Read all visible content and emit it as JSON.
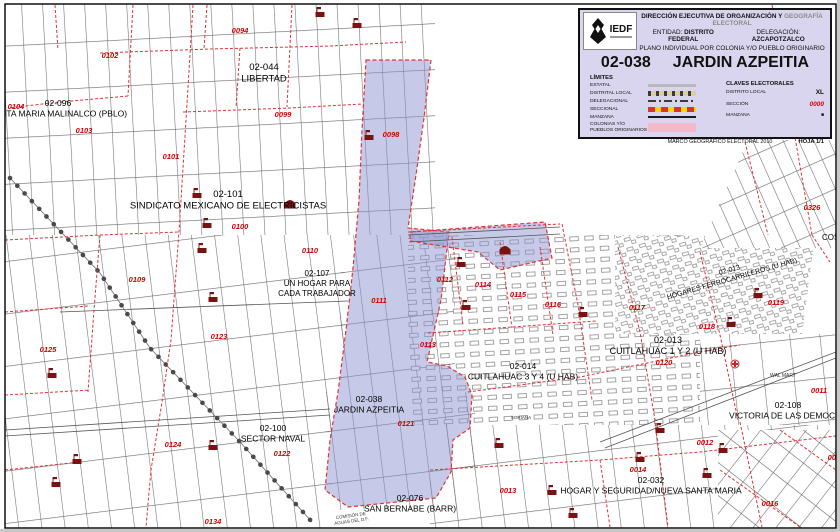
{
  "legend": {
    "logo_text": "IEDF",
    "header": {
      "line1_black": "DIRECCIÓN EJECUTIVA DE ORGANIZACIÓN Y",
      "line1_gray": "GEOGRAFÍA ELECTORAL",
      "entity_label": "ENTIDAD:",
      "entity_value": "DISTRITO FEDERAL",
      "delegation_label": "DELEGACIÓN:",
      "delegation_value": "AZCAPOTZALCO",
      "line3": "PLANO INDIVIDUAL POR COLONIA Y/O PUEBLO ORIGINARIO"
    },
    "title": {
      "code": "02-038",
      "name": "JARDIN AZPEITIA"
    },
    "limits": {
      "heading": "LÍMITES",
      "rows": [
        {
          "label": "ESTATAL",
          "symbol": "estatal-line"
        },
        {
          "label": "DISTRITAL LOCAL",
          "symbol": "dotted-line"
        },
        {
          "label": "DELEGACIONAL",
          "symbol": "dash-dot-line"
        },
        {
          "label": "SECCIONAL",
          "symbol": "yellow-red-dashed-band"
        },
        {
          "label": "MANZANA",
          "symbol": "solid-line"
        },
        {
          "label": "COLONIAS Y/O PUEBLOS ORIGINARIOS",
          "symbol": "pink-fill"
        }
      ]
    },
    "claves": {
      "heading": "CLAVES ELECTORALES",
      "rows": [
        {
          "label": "DISTRITO LOCAL",
          "value": "XL"
        },
        {
          "label": "SECCIÓN",
          "value": "0000"
        },
        {
          "label": "MANZANA",
          "value": "■"
        }
      ]
    },
    "footer": {
      "left": "MARCO GEOGRÁFICO ELECTORAL  2010",
      "right": "HOJA 1/1"
    }
  },
  "map": {
    "colors": {
      "section_red": "#d40000",
      "boundary_red": "#e23333",
      "colonia_fill": "#c6c8e8",
      "legend_bg": "#dad5ee",
      "seccional_yellow": "#ffd800",
      "colonia_symbol_pink": "#f4b9c9",
      "icon_maroon": "#7a1212"
    },
    "sections": [
      {
        "code": "0094",
        "x": 240,
        "y": 33
      },
      {
        "code": "0102",
        "x": 110,
        "y": 58
      },
      {
        "code": "0104",
        "x": 16,
        "y": 109
      },
      {
        "code": "0099",
        "x": 283,
        "y": 117
      },
      {
        "code": "0103",
        "x": 84,
        "y": 133
      },
      {
        "code": "0098",
        "x": 391,
        "y": 137
      },
      {
        "code": "0101",
        "x": 171,
        "y": 159
      },
      {
        "code": "0326",
        "x": 812,
        "y": 210
      },
      {
        "code": "0100",
        "x": 240,
        "y": 229
      },
      {
        "code": "0110",
        "x": 310,
        "y": 253
      },
      {
        "code": "0109",
        "x": 137,
        "y": 282
      },
      {
        "code": "0112",
        "x": 445,
        "y": 282
      },
      {
        "code": "0114",
        "x": 483,
        "y": 287
      },
      {
        "code": "0115",
        "x": 518,
        "y": 297
      },
      {
        "code": "0111",
        "x": 379,
        "y": 303
      },
      {
        "code": "0119",
        "x": 776,
        "y": 305
      },
      {
        "code": "0116",
        "x": 553,
        "y": 307
      },
      {
        "code": "0117",
        "x": 637,
        "y": 310
      },
      {
        "code": "0118",
        "x": 707,
        "y": 329
      },
      {
        "code": "0123",
        "x": 219,
        "y": 339
      },
      {
        "code": "0113",
        "x": 428,
        "y": 347
      },
      {
        "code": "0125",
        "x": 48,
        "y": 352
      },
      {
        "code": "0120",
        "x": 664,
        "y": 365
      },
      {
        "code": "0011",
        "x": 819,
        "y": 393
      },
      {
        "code": "0121",
        "x": 406,
        "y": 426
      },
      {
        "code": "0012",
        "x": 705,
        "y": 445
      },
      {
        "code": "0124",
        "x": 173,
        "y": 447
      },
      {
        "code": "0122",
        "x": 282,
        "y": 456
      },
      {
        "code": "0015",
        "x": 836,
        "y": 460
      },
      {
        "code": "0014",
        "x": 638,
        "y": 472
      },
      {
        "code": "0013",
        "x": 508,
        "y": 493
      },
      {
        "code": "0016",
        "x": 770,
        "y": 506
      },
      {
        "code": "0134",
        "x": 213,
        "y": 524
      }
    ],
    "colonias": [
      {
        "code": "02-044",
        "name": "LIBERTAD",
        "x": 264,
        "y": 70,
        "size": 9.5
      },
      {
        "code": "02-096",
        "name": "SANTA MARIA MALINALCO (PBLO)",
        "x": 58,
        "y": 106,
        "size": 8.5
      },
      {
        "code": "02-101",
        "name": "SINDICATO MEXICANO DE ELECTRICISTAS",
        "x": 228,
        "y": 197,
        "size": 9.5
      },
      {
        "code": "02-107",
        "name": "UN HOGAR PARA|CADA TRABAJADOR",
        "x": 317,
        "y": 276,
        "size": 8
      },
      {
        "code": "02-013",
        "name": "HOGARES FERROCARRILEROS (U HAB)",
        "x": 730,
        "y": 272,
        "size": 7,
        "rotate": -16
      },
      {
        "code": "02-013",
        "name": "CUITLAHUAC 1 Y 2 (U HAB)",
        "x": 668,
        "y": 343,
        "size": 9
      },
      {
        "code": "02-014",
        "name": "CUITLAHUAC 3 Y 4 (U HAB)",
        "x": 523,
        "y": 369,
        "size": 8.5
      },
      {
        "code": "02-038",
        "name": "JARDIN AZPEITIA",
        "x": 369,
        "y": 402,
        "size": 8.5
      },
      {
        "code": "02-108",
        "name": "VICTORIA DE LAS DEMOCRA",
        "x": 788,
        "y": 408,
        "size": 8.5
      },
      {
        "code": "02-100",
        "name": "SECTOR NAVAL",
        "x": 273,
        "y": 431,
        "size": 8.5
      },
      {
        "code": "02-032",
        "name": "HOGAR Y SEGURIDAD/NUEVA SANTA MARIA",
        "x": 651,
        "y": 483,
        "size": 8.5
      },
      {
        "code": "02-076",
        "name": "SAN BERNABE (BARR)",
        "x": 410,
        "y": 501,
        "size": 8.5
      },
      {
        "code": "",
        "name": "COS",
        "x": 822,
        "y": 240,
        "size": 8,
        "anchor": "start"
      }
    ],
    "pois": [
      {
        "text": "WAL MART",
        "x": 783,
        "y": 377,
        "size": 5
      },
      {
        "text": "SORIANA",
        "x": 521,
        "y": 419,
        "size": 4.5
      },
      {
        "lines": [
          "COMISIÓN DE",
          "AGUAS DEL D.F."
        ],
        "x": 351,
        "y": 517,
        "size": 4.5,
        "rotate": -8
      }
    ],
    "icons": [
      {
        "x": 320,
        "y": 12,
        "type": "building"
      },
      {
        "x": 357,
        "y": 23,
        "type": "building"
      },
      {
        "x": 369,
        "y": 135,
        "type": "building"
      },
      {
        "x": 197,
        "y": 193,
        "type": "building"
      },
      {
        "x": 290,
        "y": 203,
        "type": "school"
      },
      {
        "x": 207,
        "y": 223,
        "type": "building"
      },
      {
        "x": 202,
        "y": 248,
        "type": "building"
      },
      {
        "x": 505,
        "y": 249,
        "type": "school"
      },
      {
        "x": 461,
        "y": 262,
        "type": "building"
      },
      {
        "x": 758,
        "y": 293,
        "type": "building"
      },
      {
        "x": 213,
        "y": 297,
        "type": "building"
      },
      {
        "x": 466,
        "y": 305,
        "type": "building"
      },
      {
        "x": 583,
        "y": 312,
        "type": "building"
      },
      {
        "x": 731,
        "y": 322,
        "type": "building"
      },
      {
        "x": 735,
        "y": 364,
        "type": "medical-cross"
      },
      {
        "x": 52,
        "y": 373,
        "type": "building"
      },
      {
        "x": 660,
        "y": 428,
        "type": "building"
      },
      {
        "x": 499,
        "y": 443,
        "type": "building"
      },
      {
        "x": 213,
        "y": 445,
        "type": "building"
      },
      {
        "x": 723,
        "y": 448,
        "type": "building"
      },
      {
        "x": 640,
        "y": 457,
        "type": "building"
      },
      {
        "x": 77,
        "y": 459,
        "type": "building"
      },
      {
        "x": 707,
        "y": 473,
        "type": "building"
      },
      {
        "x": 56,
        "y": 482,
        "type": "building"
      },
      {
        "x": 552,
        "y": 490,
        "type": "building"
      },
      {
        "x": 573,
        "y": 513,
        "type": "building"
      }
    ]
  }
}
